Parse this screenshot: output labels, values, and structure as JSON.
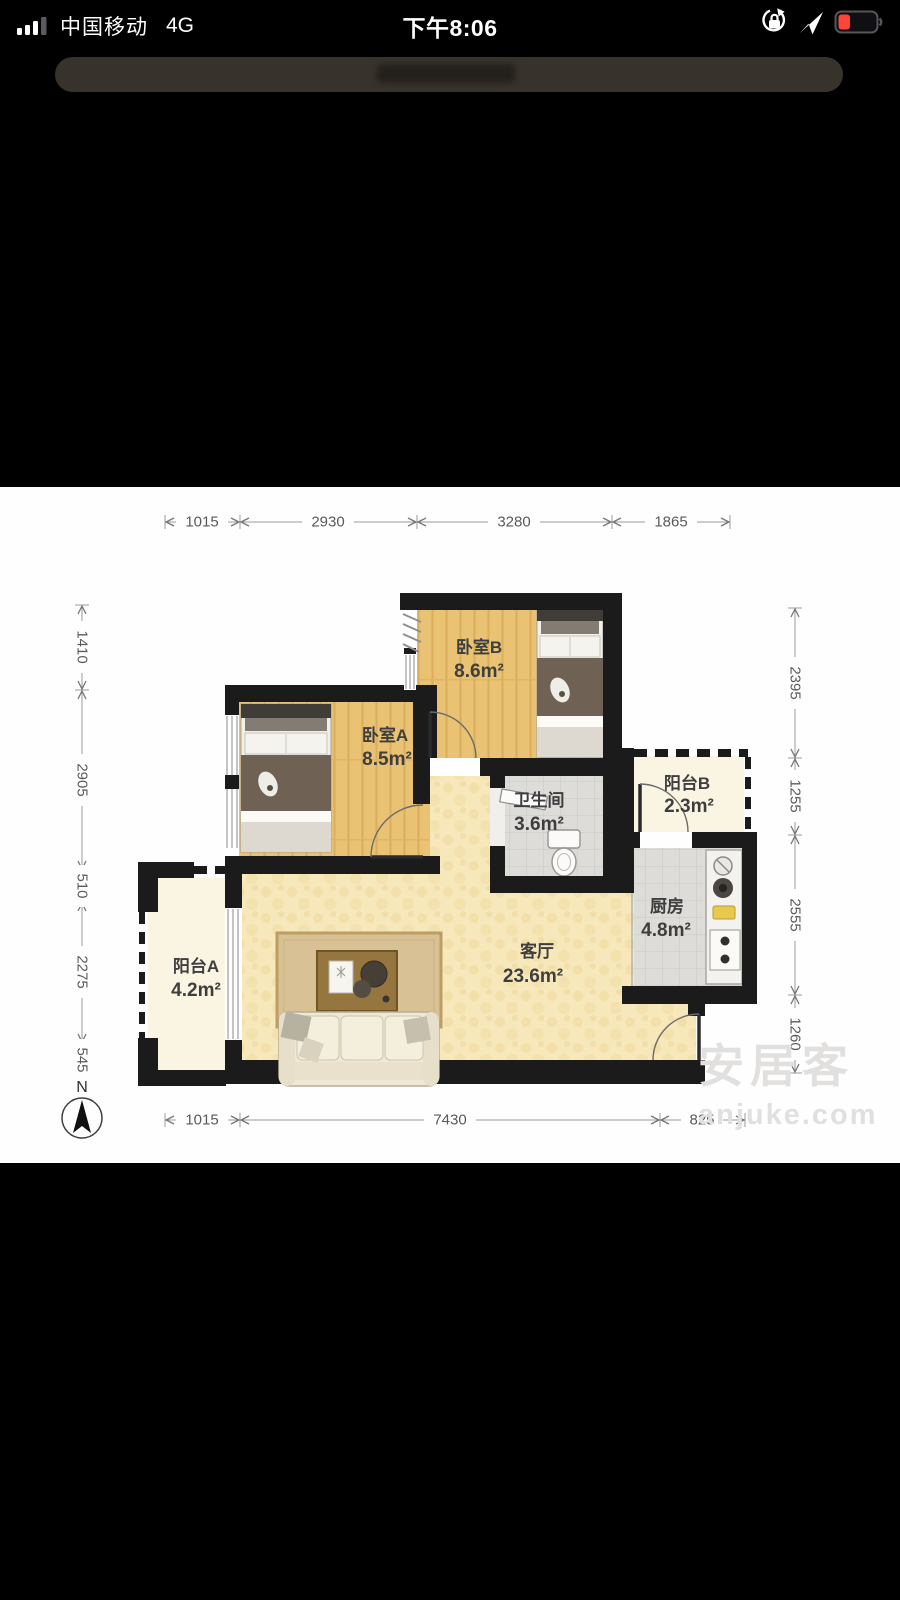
{
  "status_bar": {
    "carrier": "中国移动",
    "network": "4G",
    "time": "下午8:06",
    "icons": {
      "signal": "signal-bars",
      "lock": "orientation-lock",
      "location": "location-arrow",
      "battery": "battery-low"
    }
  },
  "floorplan": {
    "compass": "N",
    "rooms": {
      "bedroom_b": {
        "name": "卧室B",
        "area": "8.6m²"
      },
      "bedroom_a": {
        "name": "卧室A",
        "area": "8.5m²"
      },
      "bathroom": {
        "name": "卫生间",
        "area": "3.6m²"
      },
      "balcony_b": {
        "name": "阳台B",
        "area": "2.3m²"
      },
      "kitchen": {
        "name": "厨房",
        "area": "4.8m²"
      },
      "living": {
        "name": "客厅",
        "area": "23.6m²"
      },
      "balcony_a": {
        "name": "阳台A",
        "area": "4.2m²"
      }
    },
    "dims": {
      "top": [
        "1015",
        "2930",
        "3280",
        "1865"
      ],
      "bottom": [
        "1015",
        "7430",
        "825"
      ],
      "left": [
        "1410",
        "2905",
        "510",
        "2275",
        "545"
      ],
      "right": [
        "2395",
        "1255",
        "2555",
        "1260"
      ]
    },
    "watermark": {
      "brand": "安居客",
      "domain": "anjuke.com"
    }
  },
  "colors": {
    "battery_red": "#ff453a",
    "wall": "#1b1b1b",
    "wood_floor": "#e9c273",
    "living_floor": "#f6e8ba",
    "tile_floor": "#dddcd9",
    "balcony_floor": "#faf5e3",
    "label_text": "#3e3e3e",
    "dim_text": "#5a5a5a",
    "watermark_gray": "#e2e0df"
  }
}
